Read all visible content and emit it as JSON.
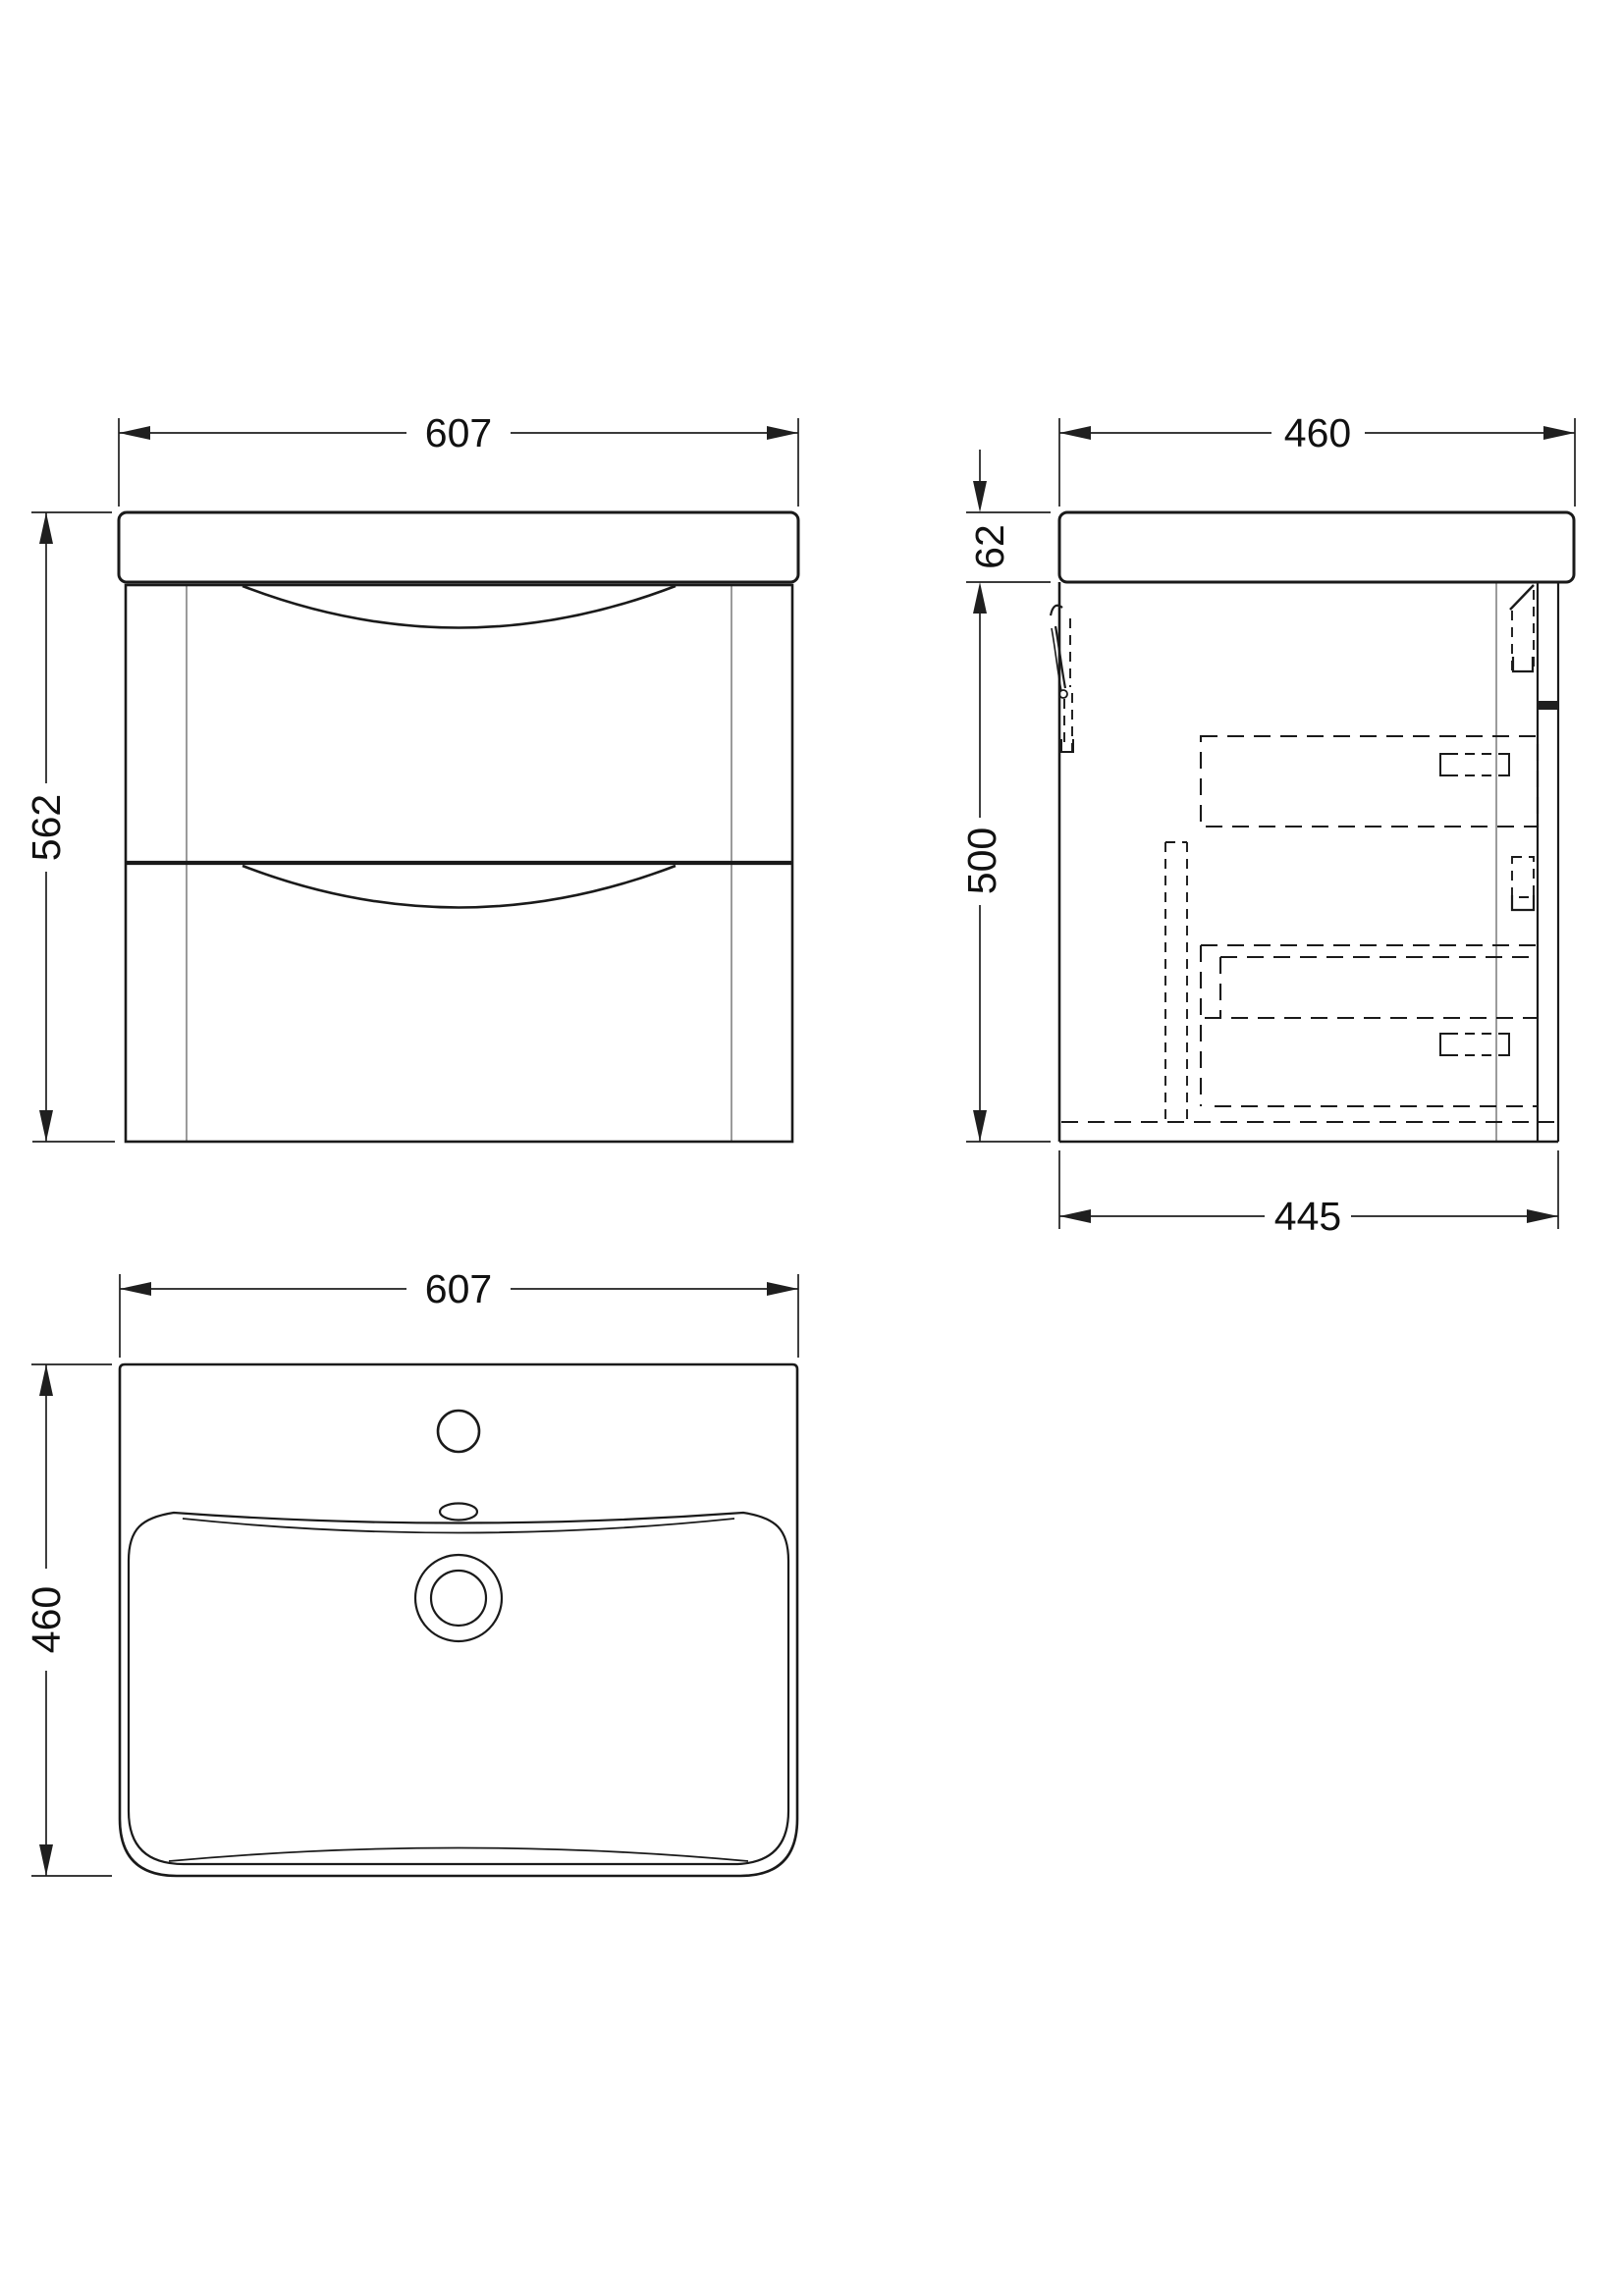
{
  "drawing": {
    "type": "technical-dimension-drawing",
    "subject": "wall-hung vanity unit with basin, three orthographic views",
    "colors": {
      "background": "#ffffff",
      "line": "#1a1a1a",
      "hidden_line_gray": "#9b9b9b"
    },
    "views": {
      "front_elevation": {
        "width": "607",
        "overall_height": "562"
      },
      "side_elevation": {
        "overall_depth": "460",
        "basin_thickness": "62",
        "cabinet_height": "500",
        "cabinet_depth": "445"
      },
      "plan": {
        "basin_width": "607",
        "basin_depth": "460"
      }
    }
  }
}
